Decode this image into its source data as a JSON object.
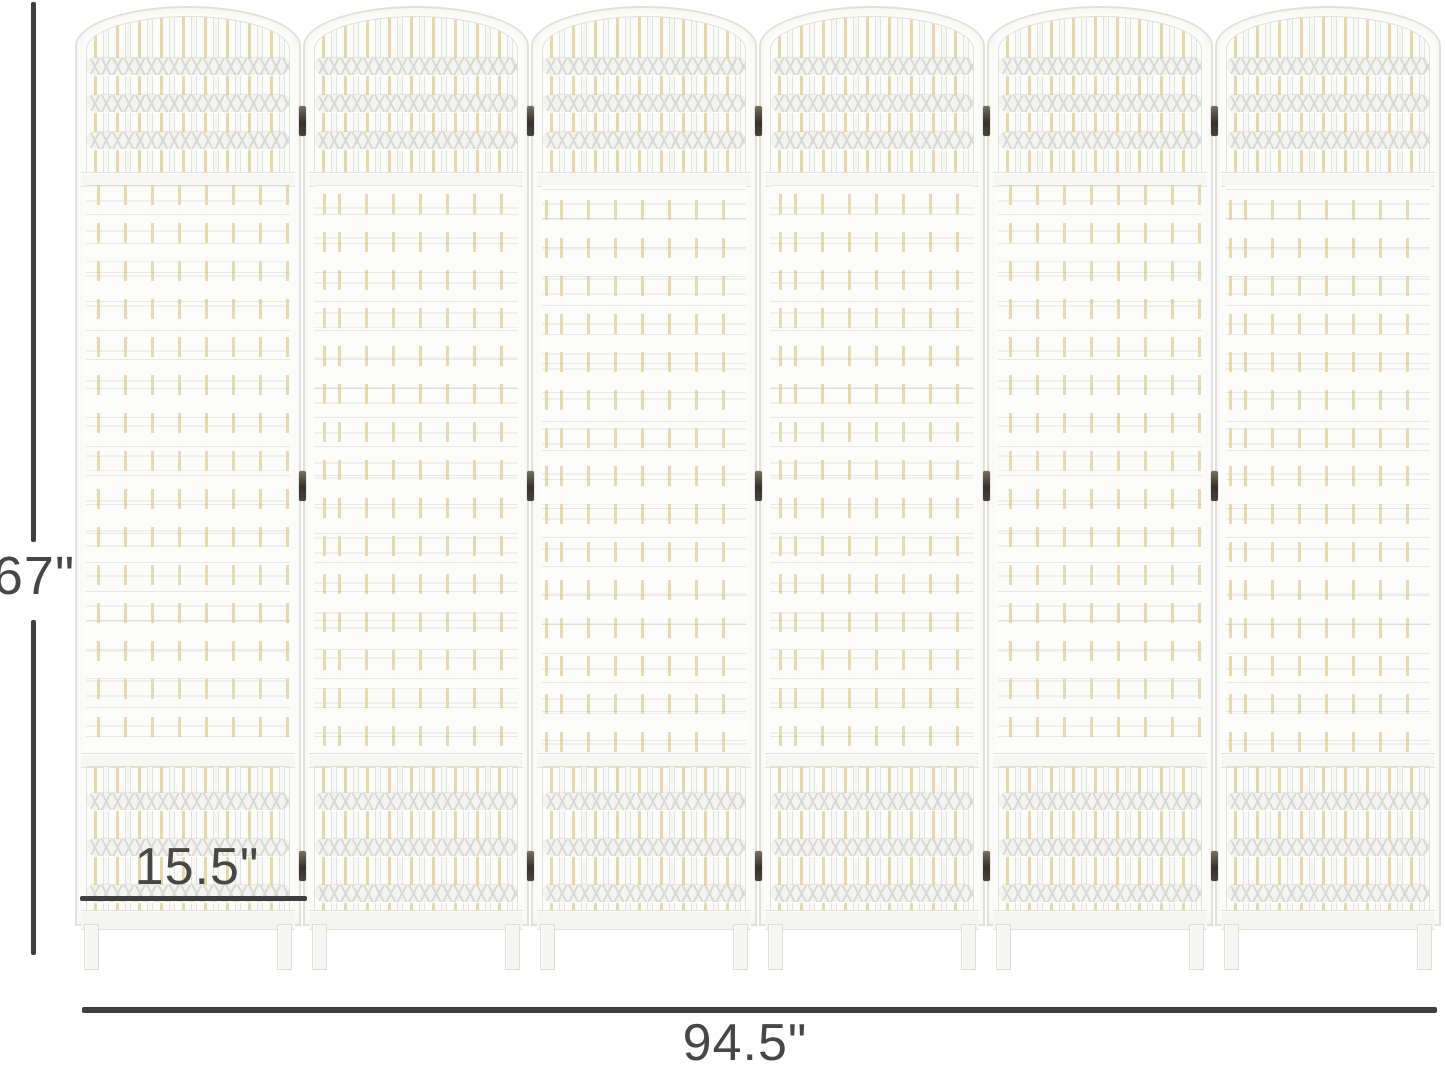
{
  "image": {
    "description": "Six-panel white woven wicker folding room divider shown with product dimensions",
    "background_color": "#ffffff"
  },
  "divider": {
    "panel_count": 6,
    "hinge_junctions": 5,
    "hinge_rows_per_junction": 3,
    "colors": {
      "panel_white": "#fcfcfa",
      "frame_edge": "#e1e0da",
      "weave_cream_accent": "#e7d8a6",
      "lattice_gray": "#d9d9d3",
      "hinge_dark": "#35302a"
    }
  },
  "dimensions": {
    "height_label": "67\"",
    "panel_width_label": "15.5\"",
    "total_width_label": "94.5\""
  },
  "annotation": {
    "line_color": "#3f3f3f",
    "text_color": "#474747"
  }
}
